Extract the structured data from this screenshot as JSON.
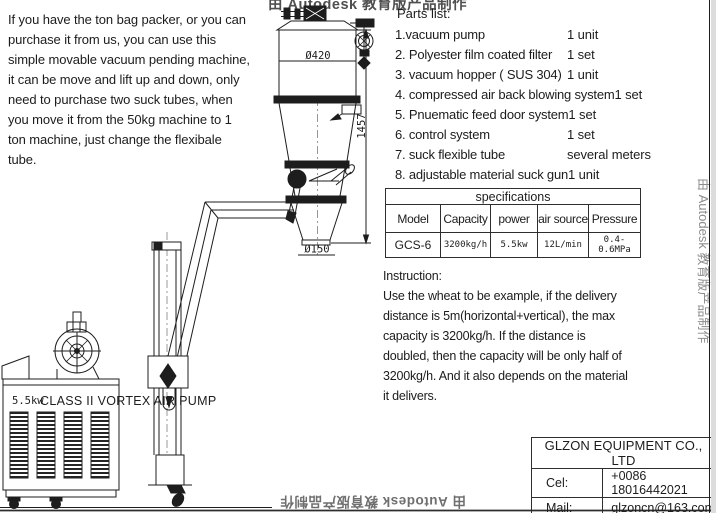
{
  "intro_text": "If you have the ton bag packer, or you can\npurchase it from us, you can use this\nsimple movable vacuum pending machine,\nit can be move and lift up and down, only\nneed to purchase two suck tubes, when\nyou move it from the 50kg machine to 1\nton machine, just change the flexibale\ntube.",
  "parts_list": {
    "title": "Parts list:",
    "items": [
      {
        "name": "1.vacuum pump",
        "qty": "1 unit"
      },
      {
        "name": "2. Polyester film coated filter",
        "qty": "1 set"
      },
      {
        "name": "3. vacuum hopper ( SUS 304)",
        "qty": "1 unit"
      },
      {
        "name": "4. compressed air back blowing system",
        "qty": "1 set"
      },
      {
        "name": "5. Pnuematic feed door system",
        "qty": "1 set"
      },
      {
        "name": "6. control system",
        "qty": "1 set"
      },
      {
        "name": "7. suck flexible tube",
        "qty": "several meters"
      },
      {
        "name": "8. adjustable material suck gun",
        "qty": "1 unit"
      }
    ]
  },
  "spec_table": {
    "title": "specifications",
    "columns": [
      "Model",
      "Capacity",
      "power",
      "air source",
      "Pressure"
    ],
    "row": [
      "GCS-6",
      "3200kg/h",
      "5.5kw",
      "12L/min",
      "0.4-0.6MPa"
    ]
  },
  "instruction_text": "Instruction:\nUse the wheat to be example, if the delivery\ndistance is 5m(horizontal+vertical), the max\ncapacity is 3200kg/h. If the distance is\ndoubled, then the capacity will be only half of\n3200kg/h. And it also depends on the material\nit delivers.",
  "diagram": {
    "dim_body_diameter": "Ø420",
    "dim_outlet_diameter": "Ø150",
    "dim_height": "1457",
    "pump_power": "5.5kw",
    "pump_name": "CLASS II VORTEX AIR PUMP"
  },
  "title_block": {
    "company": "GLZON EQUIPMENT CO., LTD",
    "phone_label": "Cel:",
    "phone": "+0086 18016442021",
    "email_label": "Mail:",
    "email": "glzoncn@163.com"
  },
  "watermark": {
    "top": "由 Autodesk 教育版产品制作",
    "right": "由 Autodesk 教育版产品制作",
    "bottom": "由 Autodesk 教育版产品制作"
  },
  "colors": {
    "ink": "#1d1d1d",
    "border": "#2e2e2e",
    "watermark_gray": "#8d8d8d",
    "background": "#ffffff"
  }
}
